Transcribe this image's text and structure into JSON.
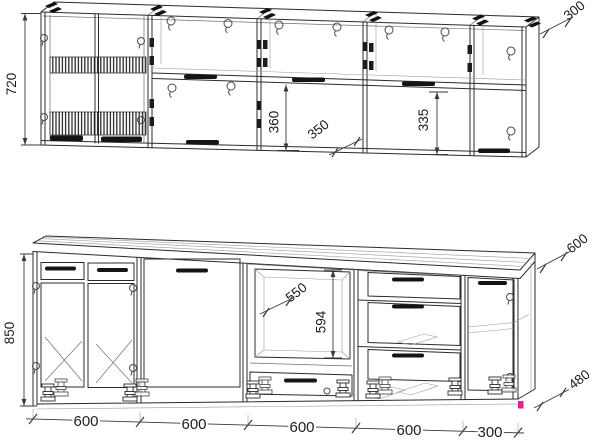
{
  "diagram": {
    "upper_row": {
      "height_label": "720",
      "depth_label": "300",
      "open_section_height_label": "360",
      "flap_section_label": "350",
      "right_section_height_label": "335"
    },
    "base_row": {
      "height_label": "850",
      "niche_depth_label": "550",
      "niche_height_label": "594",
      "countertop_depth_label": "600",
      "end_panel_label": "480",
      "module_width_labels": [
        "600",
        "600",
        "600",
        "600",
        "300"
      ]
    },
    "colors": {
      "line": "#2b2b2b",
      "dimension_text": "#1c1c1c",
      "accent_marker": "#ea1f8f",
      "background": "#ffffff"
    }
  }
}
